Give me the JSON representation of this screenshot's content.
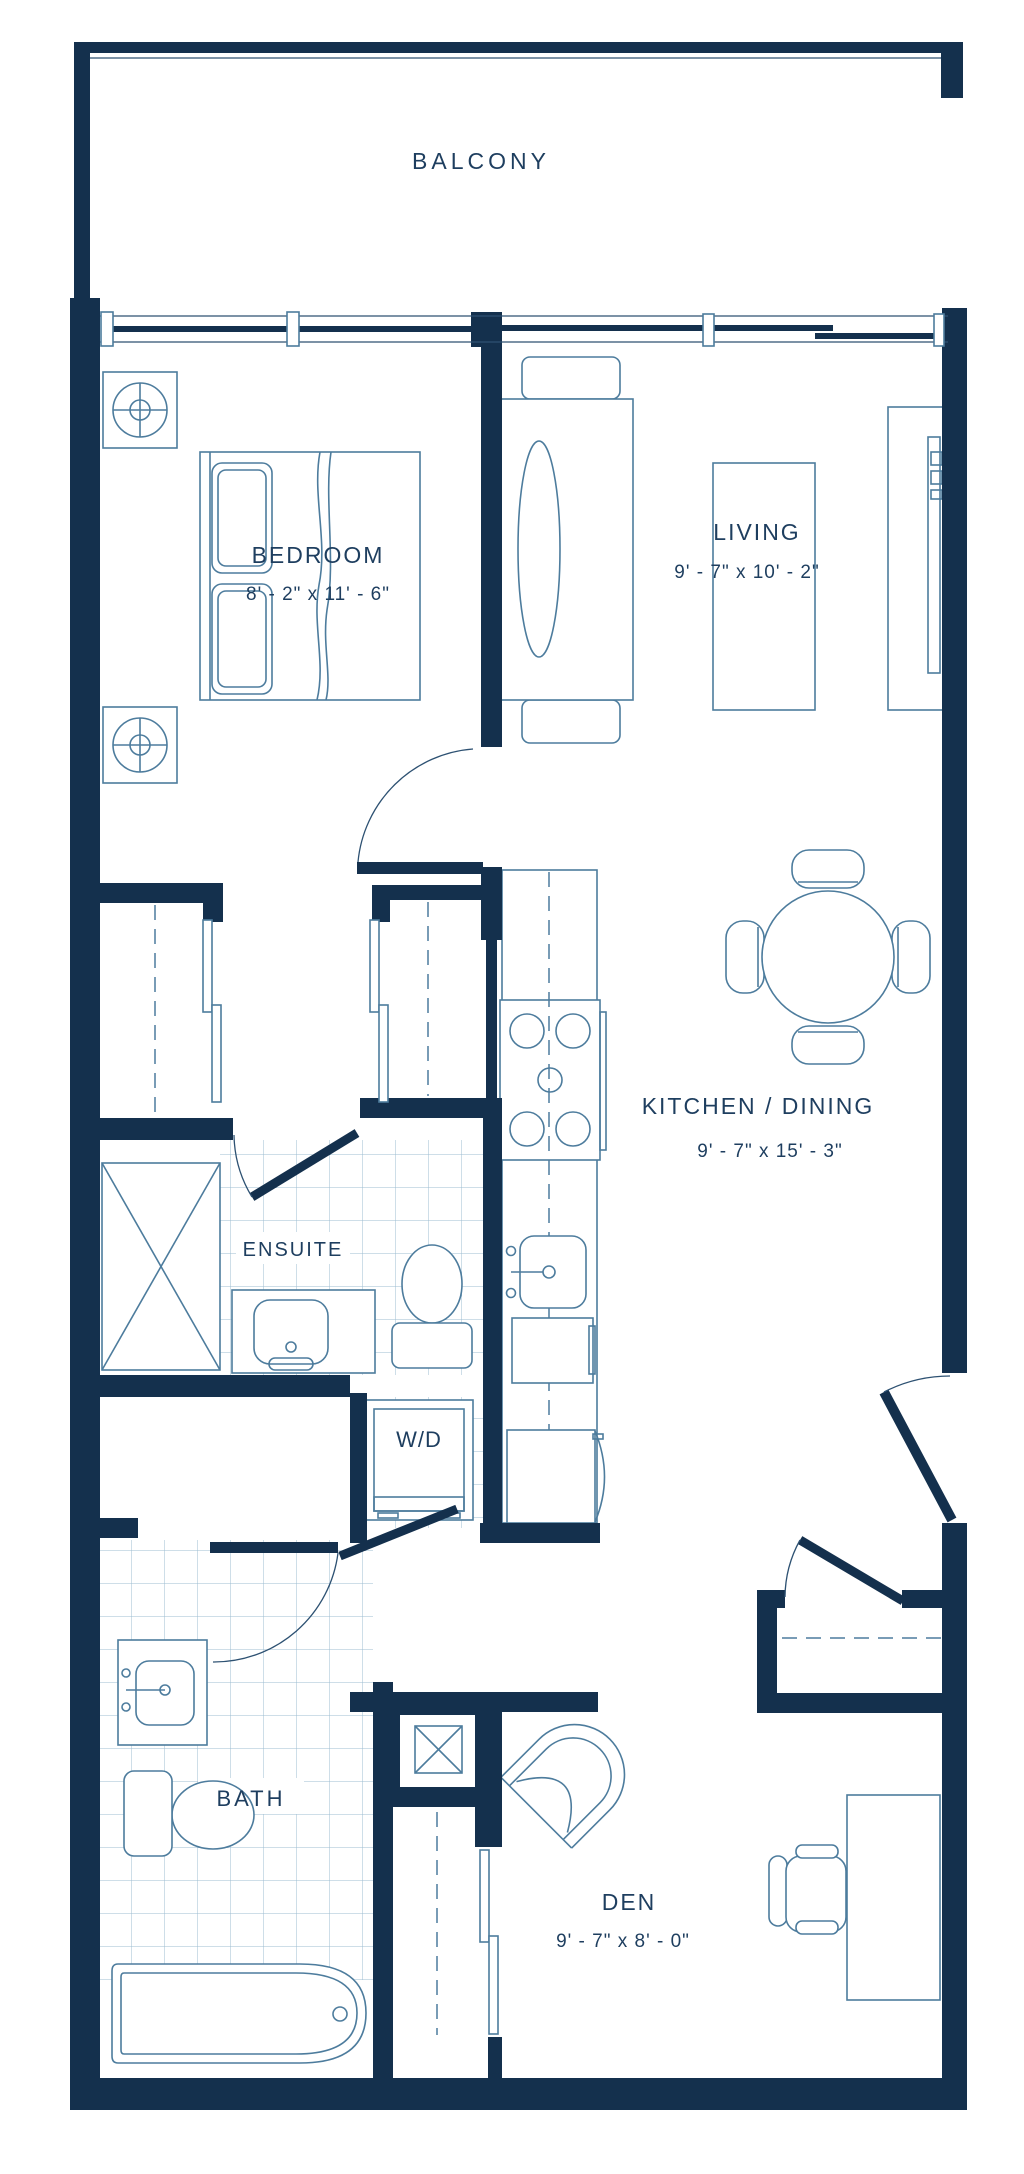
{
  "plan": {
    "type": "condo-unit-floor-plan",
    "rooms": {
      "balcony": {
        "label": "BALCONY"
      },
      "bedroom": {
        "label": "BEDROOM",
        "dims": "8' - 2\" x 11' - 6\""
      },
      "living": {
        "label": "LIVING",
        "dims": "9' - 7\" x 10' - 2\""
      },
      "kitchen_dining": {
        "label": "KITCHEN / DINING",
        "dims": "9' - 7\" x 15' - 3\""
      },
      "ensuite": {
        "label": "ENSUITE"
      },
      "laundry": {
        "label": "W/D"
      },
      "bath": {
        "label": "BATH"
      },
      "den": {
        "label": "DEN",
        "dims": "9' - 7\" x 8' - 0\""
      }
    },
    "colors": {
      "wall": "#14304d",
      "furniture_line": "#4d7c9d",
      "tile_line": "#9cbcd2",
      "text": "#1e3e5f",
      "background": "#ffffff"
    }
  }
}
